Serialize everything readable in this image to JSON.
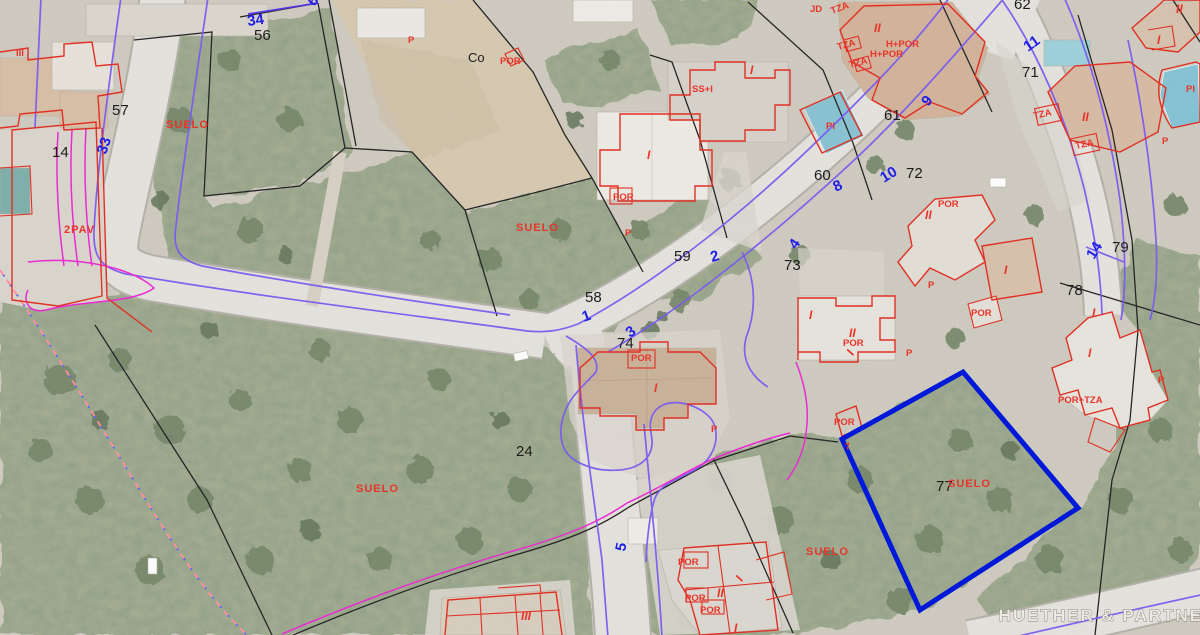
{
  "map": {
    "watermark": "HUETHER & PARTNER",
    "colors": {
      "parcel_line_black": "#262626",
      "street_number_blue": "#1f1fe8",
      "cadastral_red": "#e8342a",
      "boundary_purple": "#7a5cf0",
      "contour_magenta": "#ea2bd0",
      "highlight_parcel_blue": "#0018d8"
    },
    "highlight_parcel": {
      "number": "77",
      "land_use": "SUELO"
    },
    "labels": {
      "parcel_numbers": [
        {
          "text": "62",
          "x": 1014,
          "y": 9,
          "rot": 0,
          "cls": "k"
        },
        {
          "text": "56",
          "x": 254,
          "y": 40,
          "rot": 0,
          "cls": "k"
        },
        {
          "text": "57",
          "x": 112,
          "y": 115,
          "rot": 0,
          "cls": "k"
        },
        {
          "text": "14",
          "x": 52,
          "y": 157,
          "rot": 0,
          "cls": "k"
        },
        {
          "text": "71",
          "x": 1022,
          "y": 77,
          "rot": 0,
          "cls": "k"
        },
        {
          "text": "61",
          "x": 884,
          "y": 120,
          "rot": 0,
          "cls": "k"
        },
        {
          "text": "60",
          "x": 814,
          "y": 180,
          "rot": 0,
          "cls": "k"
        },
        {
          "text": "72",
          "x": 906,
          "y": 178,
          "rot": 0,
          "cls": "k"
        },
        {
          "text": "59",
          "x": 674,
          "y": 261,
          "rot": 0,
          "cls": "k"
        },
        {
          "text": "73",
          "x": 784,
          "y": 270,
          "rot": 0,
          "cls": "k"
        },
        {
          "text": "58",
          "x": 585,
          "y": 302,
          "rot": 0,
          "cls": "k"
        },
        {
          "text": "74",
          "x": 617,
          "y": 348,
          "rot": 0,
          "cls": "k"
        },
        {
          "text": "78",
          "x": 1066,
          "y": 295,
          "rot": 0,
          "cls": "k"
        },
        {
          "text": "79",
          "x": 1112,
          "y": 252,
          "rot": 0,
          "cls": "k"
        },
        {
          "text": "24",
          "x": 516,
          "y": 456,
          "rot": 0,
          "cls": "k"
        },
        {
          "text": "77",
          "x": 936,
          "y": 491,
          "rot": 0,
          "cls": "k"
        },
        {
          "text": "Co",
          "x": 468,
          "y": 62,
          "rot": 0,
          "cls": "ks"
        }
      ],
      "street_numbers": [
        {
          "text": "34",
          "x": 248,
          "y": 26,
          "rot": -8,
          "cls": "b"
        },
        {
          "text": "33",
          "x": 106,
          "y": 155,
          "rot": -72,
          "cls": "b"
        },
        {
          "text": "6",
          "x": 314,
          "y": 7,
          "rot": -50,
          "cls": "b"
        },
        {
          "text": "1",
          "x": 584,
          "y": 322,
          "rot": -20,
          "cls": "b"
        },
        {
          "text": "2",
          "x": 712,
          "y": 262,
          "rot": -16,
          "cls": "b"
        },
        {
          "text": "3",
          "x": 630,
          "y": 338,
          "rot": -35,
          "cls": "b"
        },
        {
          "text": "4",
          "x": 796,
          "y": 250,
          "rot": -55,
          "cls": "b"
        },
        {
          "text": "5",
          "x": 625,
          "y": 552,
          "rot": -78,
          "cls": "b"
        },
        {
          "text": "8",
          "x": 836,
          "y": 192,
          "rot": -26,
          "cls": "b"
        },
        {
          "text": "9",
          "x": 928,
          "y": 107,
          "rot": -50,
          "cls": "b"
        },
        {
          "text": "10",
          "x": 884,
          "y": 183,
          "rot": -32,
          "cls": "b"
        },
        {
          "text": "11",
          "x": 1028,
          "y": 52,
          "rot": -36,
          "cls": "b"
        },
        {
          "text": "14",
          "x": 1094,
          "y": 260,
          "rot": -58,
          "cls": "b"
        }
      ],
      "cadastral_red": [
        {
          "text": "SUELO",
          "x": 166,
          "y": 128,
          "rot": 0,
          "cls": "r"
        },
        {
          "text": "SUELO",
          "x": 516,
          "y": 231,
          "rot": 0,
          "cls": "r"
        },
        {
          "text": "SUELO",
          "x": 356,
          "y": 492,
          "rot": 0,
          "cls": "r"
        },
        {
          "text": "SUELO",
          "x": 948,
          "y": 487,
          "rot": 0,
          "cls": "r"
        },
        {
          "text": "SUELO",
          "x": 806,
          "y": 555,
          "rot": 0,
          "cls": "r"
        },
        {
          "text": "2PAV",
          "x": 64,
          "y": 233,
          "rot": 0,
          "cls": "r"
        },
        {
          "text": "P",
          "x": 408,
          "y": 43,
          "rot": 0,
          "cls": "rs"
        },
        {
          "text": "P",
          "x": 625,
          "y": 236,
          "rot": 0,
          "cls": "rs"
        },
        {
          "text": "P",
          "x": 711,
          "y": 432,
          "rot": 0,
          "cls": "rs"
        },
        {
          "text": "P",
          "x": 906,
          "y": 356,
          "rot": 0,
          "cls": "rs"
        },
        {
          "text": "P",
          "x": 928,
          "y": 288,
          "rot": 0,
          "cls": "rs"
        },
        {
          "text": "P",
          "x": 1162,
          "y": 144,
          "rot": 0,
          "cls": "rs"
        },
        {
          "text": "P",
          "x": 1158,
          "y": 383,
          "rot": 0,
          "cls": "rs"
        },
        {
          "text": "POR",
          "x": 500,
          "y": 64,
          "rot": 0,
          "cls": "rs"
        },
        {
          "text": "POR",
          "x": 613,
          "y": 200,
          "rot": 0,
          "cls": "rs"
        },
        {
          "text": "POR",
          "x": 631,
          "y": 361,
          "rot": 0,
          "cls": "rs"
        },
        {
          "text": "POR",
          "x": 938,
          "y": 207,
          "rot": 0,
          "cls": "rs"
        },
        {
          "text": "POR",
          "x": 971,
          "y": 316,
          "rot": 0,
          "cls": "rs"
        },
        {
          "text": "POR",
          "x": 843,
          "y": 346,
          "rot": 0,
          "cls": "rs"
        },
        {
          "text": "POR",
          "x": 834,
          "y": 425,
          "rot": 0,
          "cls": "rs"
        },
        {
          "text": "POR",
          "x": 678,
          "y": 565,
          "rot": 0,
          "cls": "rs"
        },
        {
          "text": "POR",
          "x": 685,
          "y": 601,
          "rot": 0,
          "cls": "rs"
        },
        {
          "text": "POR",
          "x": 700,
          "y": 613,
          "rot": 0,
          "cls": "rs"
        },
        {
          "text": "H+POR",
          "x": 886,
          "y": 47,
          "rot": 0,
          "cls": "rs"
        },
        {
          "text": "H+POR",
          "x": 870,
          "y": 57,
          "rot": 0,
          "cls": "rs"
        },
        {
          "text": "POR+TZA",
          "x": 1058,
          "y": 403,
          "rot": 0,
          "cls": "rs"
        },
        {
          "text": "JD",
          "x": 810,
          "y": 12,
          "rot": 0,
          "cls": "rs"
        },
        {
          "text": "TZA",
          "x": 832,
          "y": 14,
          "rot": -20,
          "cls": "rs"
        },
        {
          "text": "TZA",
          "x": 838,
          "y": 50,
          "rot": -15,
          "cls": "rs"
        },
        {
          "text": "TZA",
          "x": 850,
          "y": 68,
          "rot": -15,
          "cls": "rs"
        },
        {
          "text": "TZA",
          "x": 1034,
          "y": 119,
          "rot": -12,
          "cls": "rs"
        },
        {
          "text": "TZA",
          "x": 1076,
          "y": 149,
          "rot": -12,
          "cls": "rs"
        },
        {
          "text": "SS+I",
          "x": 692,
          "y": 92,
          "rot": 0,
          "cls": "rs"
        },
        {
          "text": "PI",
          "x": 826,
          "y": 129,
          "rot": 0,
          "cls": "rs"
        },
        {
          "text": "PI",
          "x": 1186,
          "y": 92,
          "rot": 0,
          "cls": "rs"
        },
        {
          "text": "7",
          "x": 846,
          "y": 450,
          "rot": -15,
          "cls": "rs"
        },
        {
          "text": "I",
          "x": 750,
          "y": 74,
          "rot": 0,
          "cls": "rb"
        },
        {
          "text": "I",
          "x": 1157,
          "y": 44,
          "rot": 0,
          "cls": "rb"
        },
        {
          "text": "I",
          "x": 647,
          "y": 159,
          "rot": 0,
          "cls": "rb"
        },
        {
          "text": "I",
          "x": 1004,
          "y": 274,
          "rot": 0,
          "cls": "rb"
        },
        {
          "text": "I",
          "x": 809,
          "y": 319,
          "rot": 0,
          "cls": "rb"
        },
        {
          "text": "I",
          "x": 853,
          "y": 356,
          "rot": -60,
          "cls": "rb"
        },
        {
          "text": "I",
          "x": 1092,
          "y": 317,
          "rot": 0,
          "cls": "rb"
        },
        {
          "text": "I",
          "x": 1088,
          "y": 357,
          "rot": 0,
          "cls": "rb"
        },
        {
          "text": "I",
          "x": 654,
          "y": 392,
          "rot": 0,
          "cls": "rb"
        },
        {
          "text": "I",
          "x": 742,
          "y": 582,
          "rot": -60,
          "cls": "rb"
        },
        {
          "text": "I",
          "x": 734,
          "y": 632,
          "rot": 0,
          "cls": "rb"
        },
        {
          "text": "II",
          "x": 874,
          "y": 32,
          "rot": 0,
          "cls": "rb"
        },
        {
          "text": "II",
          "x": 1082,
          "y": 121,
          "rot": 0,
          "cls": "rb"
        },
        {
          "text": "II",
          "x": 1176,
          "y": 13,
          "rot": 0,
          "cls": "rb"
        },
        {
          "text": "II",
          "x": 925,
          "y": 219,
          "rot": 0,
          "cls": "rb"
        },
        {
          "text": "II",
          "x": 849,
          "y": 337,
          "rot": 0,
          "cls": "rb"
        },
        {
          "text": "II",
          "x": 717,
          "y": 597,
          "rot": 0,
          "cls": "rb"
        },
        {
          "text": "III",
          "x": 521,
          "y": 620,
          "rot": 0,
          "cls": "rb"
        },
        {
          "text": "III",
          "x": 16,
          "y": 56,
          "rot": 0,
          "cls": "rs"
        }
      ]
    }
  }
}
